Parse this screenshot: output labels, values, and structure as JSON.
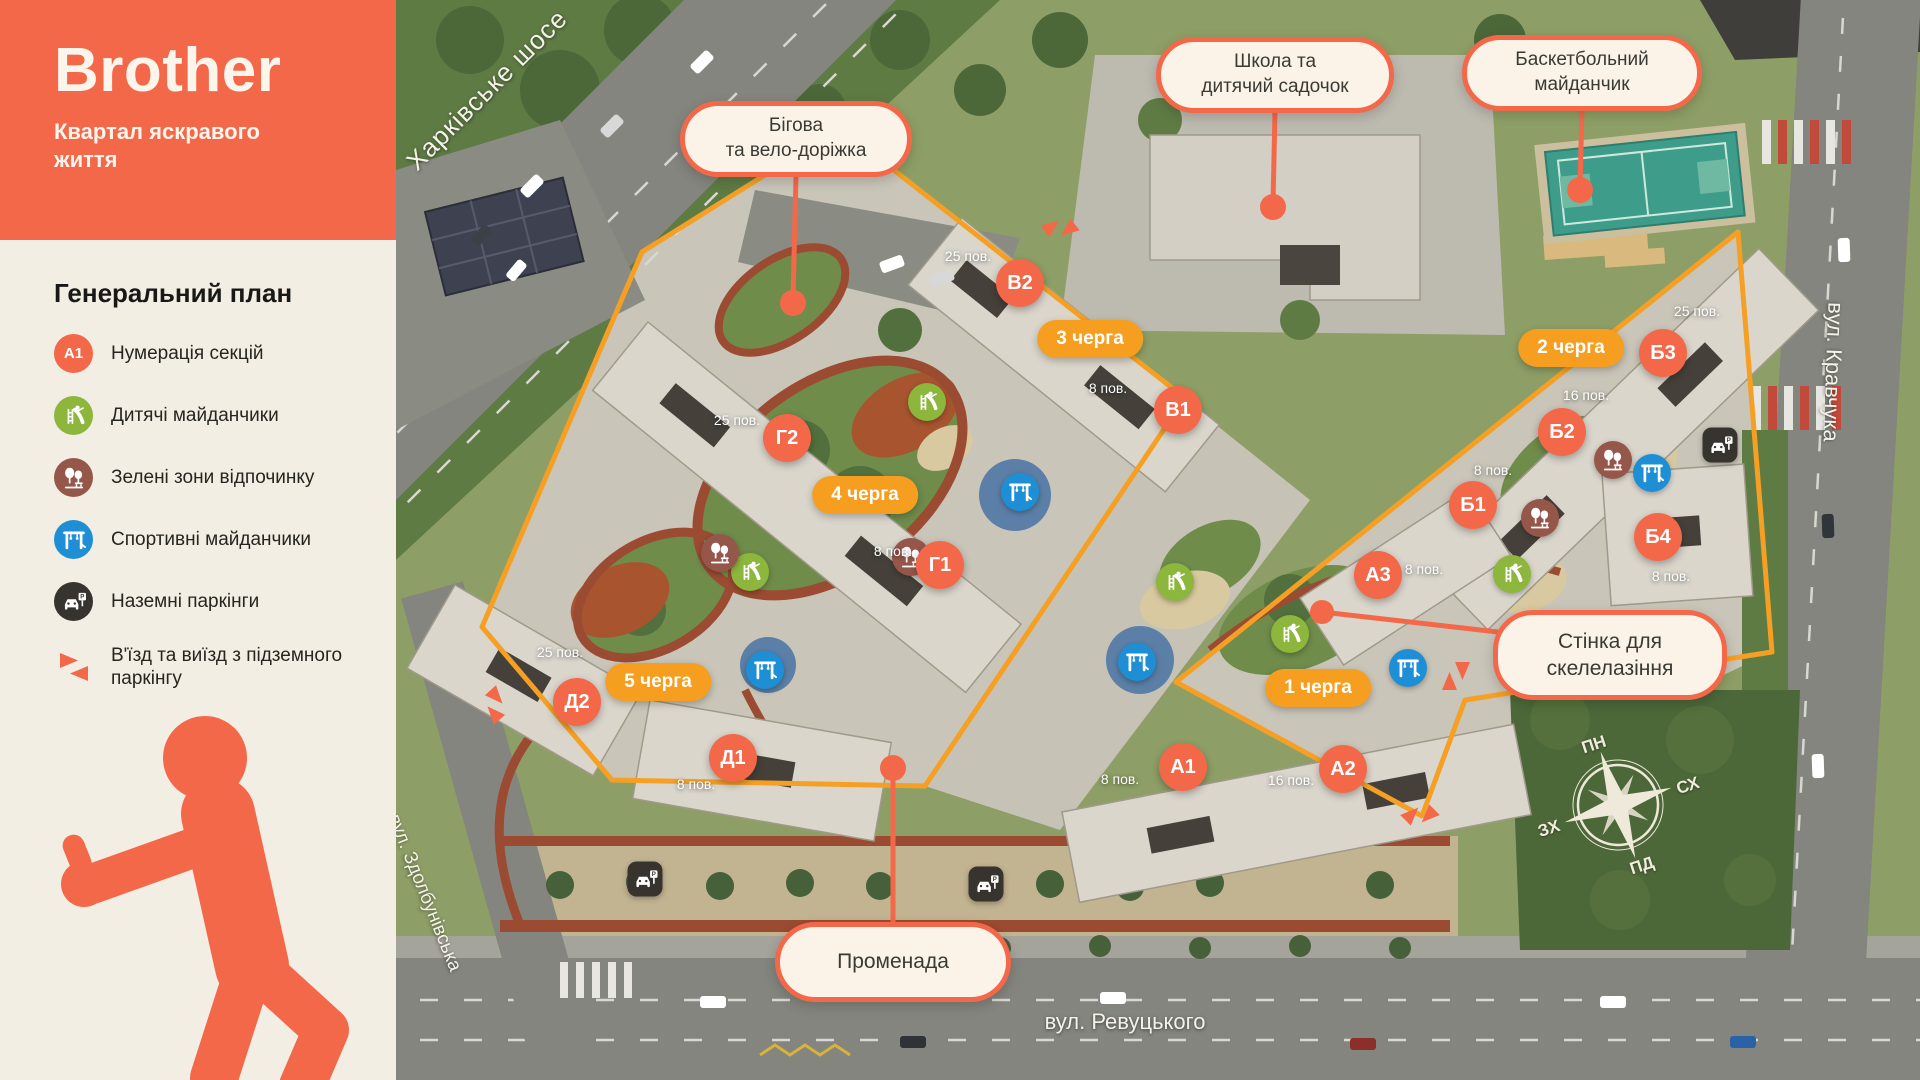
{
  "brand": {
    "name": "Brother",
    "tagline": "Квартал яскравого життя"
  },
  "sidebar": {
    "title": "Генеральний план",
    "legend": [
      {
        "icon": "section-badge",
        "badge": "А1",
        "label": "Нумерація секцій"
      },
      {
        "icon": "playground",
        "label": "Дитячі майданчики"
      },
      {
        "icon": "green-zone",
        "label": "Зелені зони відпочинку"
      },
      {
        "icon": "sports",
        "label": "Спортивні майданчики"
      },
      {
        "icon": "parking",
        "label": "Наземні паркінги"
      },
      {
        "icon": "entry-exit",
        "label": "В'їзд та виїзд з підземного паркінгу"
      }
    ]
  },
  "map": {
    "callouts": {
      "running": {
        "line1": "Бігова",
        "line2": "та вело-доріжка"
      },
      "school": {
        "line1": "Школа та",
        "line2": "дитячий садочок"
      },
      "basketball": {
        "line1": "Баскетбольний",
        "line2": "майданчик"
      },
      "climbing": {
        "line1": "Стінка для",
        "line2": "скелелазіння"
      },
      "promenade": {
        "line1": "Променада"
      }
    },
    "streets": {
      "kharkivske": "Харківське шосе",
      "kravchuka": "вул. Кравчука",
      "zdolbunivska": "вул. Здолбунівська",
      "revutskoho": "вул. Ревуцького"
    },
    "compass": {
      "north": "ПН",
      "east": "СХ",
      "south": "ПД",
      "west": "ЗХ"
    },
    "buildings": [
      {
        "label": "В2",
        "x": 1020,
        "y": 283
      },
      {
        "label": "В1",
        "x": 1178,
        "y": 410
      },
      {
        "label": "Г2",
        "x": 787,
        "y": 438
      },
      {
        "label": "Г1",
        "x": 940,
        "y": 565
      },
      {
        "label": "Д2",
        "x": 577,
        "y": 702
      },
      {
        "label": "Д1",
        "x": 733,
        "y": 758
      },
      {
        "label": "Б3",
        "x": 1663,
        "y": 353
      },
      {
        "label": "Б2",
        "x": 1562,
        "y": 432
      },
      {
        "label": "Б1",
        "x": 1473,
        "y": 505
      },
      {
        "label": "Б4",
        "x": 1658,
        "y": 537
      },
      {
        "label": "А3",
        "x": 1378,
        "y": 575
      },
      {
        "label": "А1",
        "x": 1183,
        "y": 767
      },
      {
        "label": "А2",
        "x": 1343,
        "y": 769
      }
    ],
    "floors": [
      {
        "text": "25 пов.",
        "x": 968,
        "y": 256
      },
      {
        "text": "8 пов.",
        "x": 1108,
        "y": 388
      },
      {
        "text": "25 пов.",
        "x": 737,
        "y": 420
      },
      {
        "text": "8 пов.",
        "x": 893,
        "y": 551
      },
      {
        "text": "25 пов.",
        "x": 560,
        "y": 652
      },
      {
        "text": "8 пов.",
        "x": 696,
        "y": 784
      },
      {
        "text": "25 пов.",
        "x": 1697,
        "y": 311
      },
      {
        "text": "16 пов.",
        "x": 1586,
        "y": 395
      },
      {
        "text": "8 пов.",
        "x": 1493,
        "y": 470
      },
      {
        "text": "8 пов.",
        "x": 1671,
        "y": 576
      },
      {
        "text": "8 пов.",
        "x": 1424,
        "y": 569
      },
      {
        "text": "8 пов.",
        "x": 1120,
        "y": 779
      },
      {
        "text": "16 пов.",
        "x": 1291,
        "y": 780
      }
    ],
    "phases": [
      {
        "text": "3 черга",
        "x": 1090,
        "y": 339
      },
      {
        "text": "4 черга",
        "x": 865,
        "y": 495
      },
      {
        "text": "5 черга",
        "x": 658,
        "y": 682
      },
      {
        "text": "2 черга",
        "x": 1571,
        "y": 348
      },
      {
        "text": "1 черга",
        "x": 1318,
        "y": 688
      }
    ],
    "amenities": [
      {
        "type": "playground",
        "x": 927,
        "y": 402
      },
      {
        "type": "playground",
        "x": 750,
        "y": 572
      },
      {
        "type": "playground",
        "x": 1175,
        "y": 582
      },
      {
        "type": "playground",
        "x": 1290,
        "y": 634
      },
      {
        "type": "playground",
        "x": 1512,
        "y": 574
      },
      {
        "type": "sports",
        "x": 1020,
        "y": 492
      },
      {
        "type": "sports",
        "x": 765,
        "y": 670
      },
      {
        "type": "sports",
        "x": 1137,
        "y": 662
      },
      {
        "type": "sports",
        "x": 1408,
        "y": 668
      },
      {
        "type": "sports",
        "x": 1652,
        "y": 473
      },
      {
        "type": "green-zone",
        "x": 720,
        "y": 553
      },
      {
        "type": "green-zone",
        "x": 911,
        "y": 557
      },
      {
        "type": "green-zone",
        "x": 1540,
        "y": 518
      },
      {
        "type": "green-zone",
        "x": 1613,
        "y": 460
      },
      {
        "type": "parking",
        "x": 645,
        "y": 879
      },
      {
        "type": "parking",
        "x": 986,
        "y": 884
      },
      {
        "type": "parking",
        "x": 1720,
        "y": 445
      }
    ],
    "entry_exits": [
      {
        "x": 1060,
        "y": 228,
        "rot": -38
      },
      {
        "x": 495,
        "y": 705,
        "rot": 48
      },
      {
        "x": 1456,
        "y": 676,
        "rot": 90
      },
      {
        "x": 1420,
        "y": 815,
        "rot": -45
      }
    ],
    "colors": {
      "accent": "#F4684A",
      "phase_badge": "#F59E20",
      "perimeter": "#F5A025",
      "playground": "#8CB63C",
      "sports": "#1F8FD5",
      "green_zone": "#96574B",
      "parking": "#37342F"
    }
  }
}
